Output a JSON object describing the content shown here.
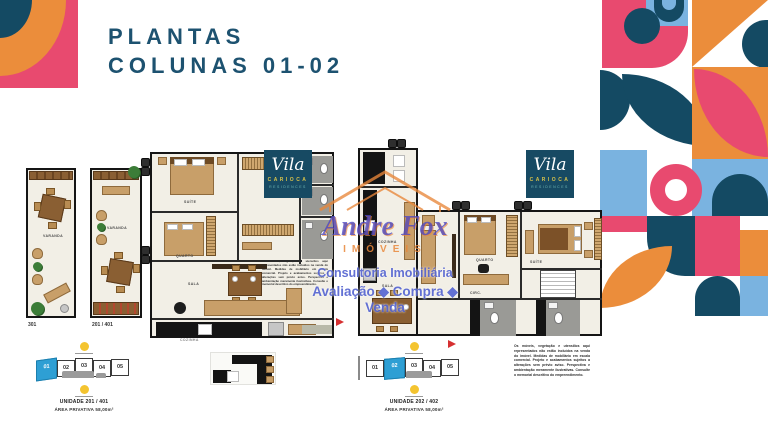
{
  "title": {
    "line1": "PLANTAS",
    "line2": "COLUNAS 01-02"
  },
  "logo": {
    "script": "Vila",
    "line2": "CARIOCA",
    "line3": "RESIDENCES"
  },
  "watermark": {
    "name": "Andre Fox",
    "subtitle": "IMÓVEIS",
    "line2": "Consultoria Imobiliária",
    "line3": "Avaliação ◆ Compra ◆ Venda"
  },
  "plans": {
    "left": {
      "strip_a_label": "301",
      "strip_b_label": "201 / 401",
      "rooms": {
        "suite": "SUÍTE",
        "quarto": "QUARTO",
        "sala": "SALA",
        "cozinha": "COZINHA",
        "varanda": "VARANDA"
      }
    },
    "right": {
      "rooms": {
        "quarto": "QUARTO",
        "suite": "SUÍTE",
        "sala": "SALA",
        "cozinha": "COZINHA",
        "circ": "CIRC."
      }
    }
  },
  "keyplans": {
    "left": {
      "units": [
        "01",
        "02",
        "03",
        "04",
        "05"
      ],
      "highlight": "01",
      "unidade": "UNIDADE 201 / 401",
      "area": "ÁREA PRIVATIVA 58,00m²"
    },
    "right": {
      "units": [
        "01",
        "02",
        "03",
        "04",
        "05"
      ],
      "highlight": "02",
      "unidade": "UNIDADE 202 / 402",
      "area": "ÁREA PRIVATIVA 58,00m²"
    }
  },
  "disclaimer": {
    "text": "Os móveis, vegetação e utensílios aqui representados não estão incluídos na venda do imóvel. Medidas de mobiliário em escala comercial. Projeto e acabamentos sujeitos a alterações sem prévio aviso. Perspectiva e ambientação meramente ilustrativas. Consulte o memorial descritivo do empreendimento."
  },
  "colors": {
    "navy": "#144a63",
    "pink": "#e84a6f",
    "orange": "#eb8d3b",
    "lightblue": "#7ab3e0",
    "keyplan_blue": "#2e9fd4",
    "title": "#1d5270"
  }
}
